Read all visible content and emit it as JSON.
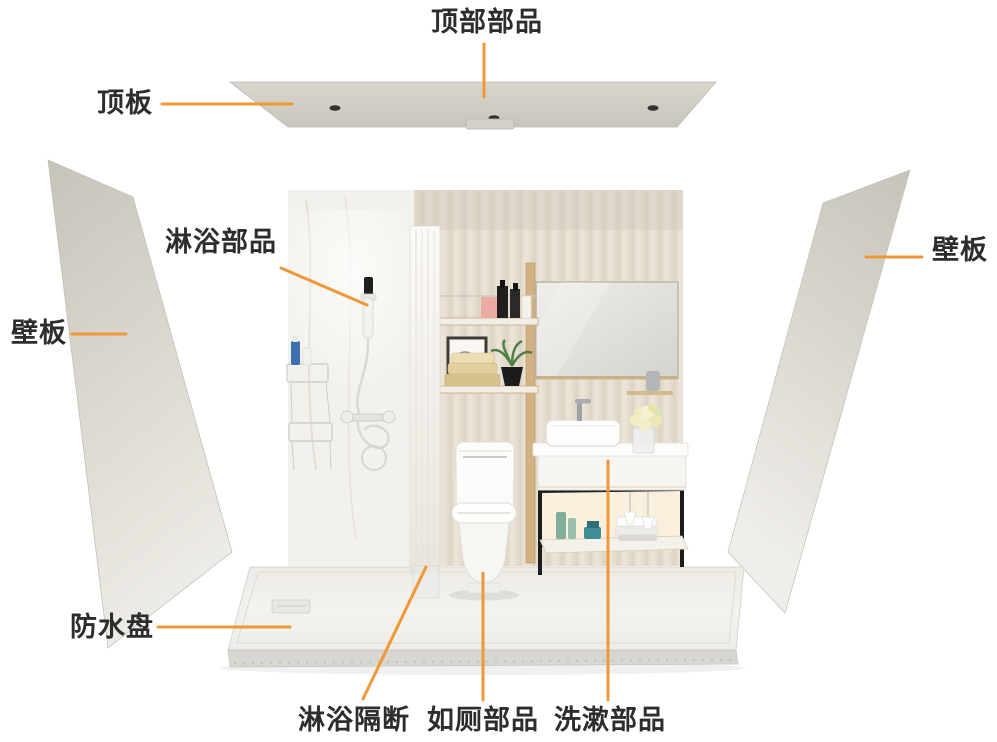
{
  "diagram": {
    "labels": {
      "top_parts": "顶部部品",
      "ceiling_panel": "顶板",
      "shower_parts": "淋浴部品",
      "wall_panel_left": "壁板",
      "wall_panel_right": "壁板",
      "waterproof_pan": "防水盘",
      "shower_partition": "淋浴隔断",
      "toilet_parts": "如厕部品",
      "washing_parts": "洗漱部品"
    },
    "colors": {
      "leader_line": "#EE9838",
      "label_text": "#2D2D2D",
      "panel_dark": "#C9C5BC",
      "panel_light": "#ECEAE4",
      "wall_beige": "#EAE3D7",
      "wood": "#D0AE7E",
      "floor": "#F1EFE9",
      "background": "#FFFFFF"
    }
  }
}
